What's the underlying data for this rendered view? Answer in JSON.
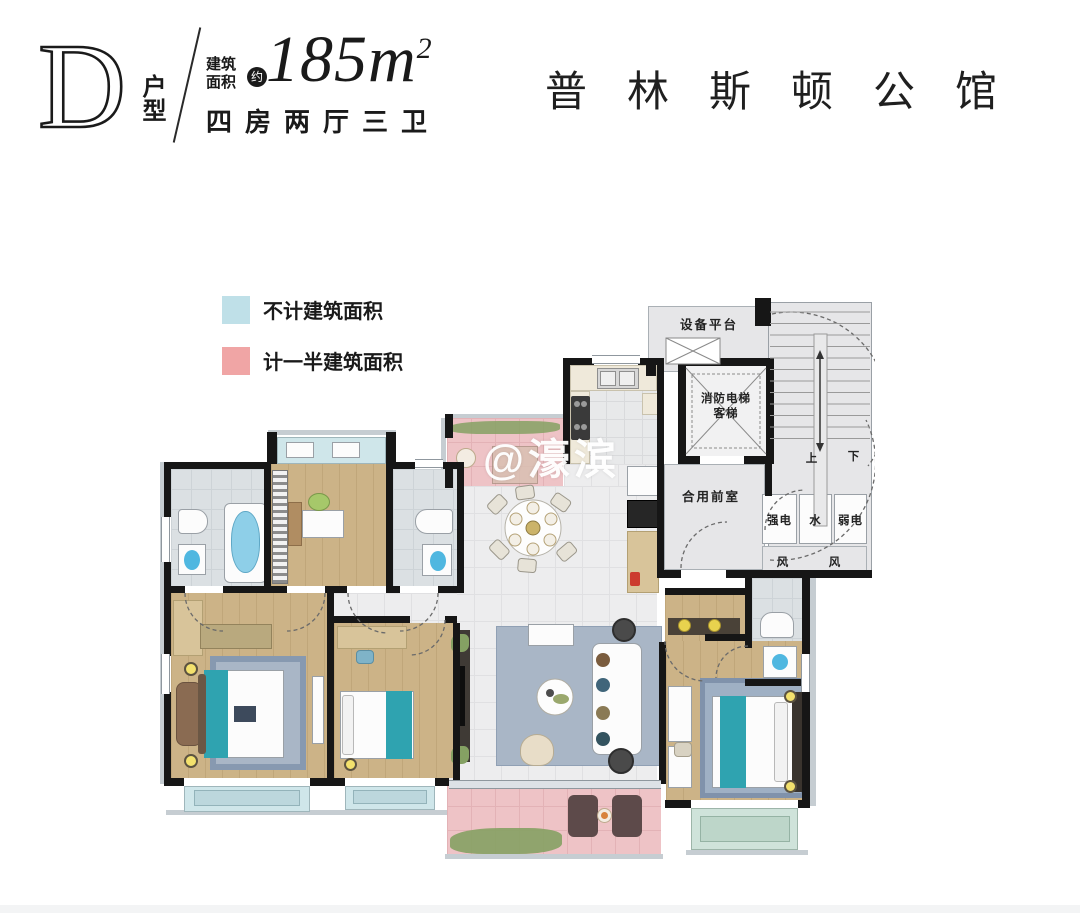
{
  "header": {
    "unit_letter": "D",
    "unit_type_label": "户型",
    "area_prefix_line1": "建筑",
    "area_prefix_line2": "面积",
    "area_approx_badge": "约",
    "area_value": "185",
    "area_unit": "m",
    "area_exponent": "2",
    "rooms_summary": "四房两厅三卫",
    "project_name": "普林斯顿公馆"
  },
  "legend": {
    "items": [
      {
        "label": "不计建筑面积",
        "color": "#bfe0e8"
      },
      {
        "label": "计一半建筑面积",
        "color": "#f0a5a5"
      }
    ]
  },
  "watermark_text": "@濠滨",
  "plan_labels": {
    "equipment_platform": "设备平台",
    "fire_elevator": "消防电梯",
    "passenger_elevator": "客梯",
    "shared_lobby": "合用前室",
    "shaft_strong_power": "强电",
    "shaft_water": "水",
    "shaft_weak_power": "弱电",
    "vent_left": "风",
    "vent_right": "风",
    "stair_up": "上",
    "stair_down": "下"
  },
  "palette": {
    "wall": "#161616",
    "wood_floor": "#ccb387",
    "tile_floor": "#ededee",
    "bath_tile": "#dde1e4",
    "core_gray": "#e4e4e6",
    "balcony_pink": "#eec3c6",
    "bay_window_blue": "#cfe6ea",
    "bay_window_green": "#cfe3da",
    "accent_teal": "#2fa3b0",
    "rug_blue": "#a9b6c6"
  }
}
